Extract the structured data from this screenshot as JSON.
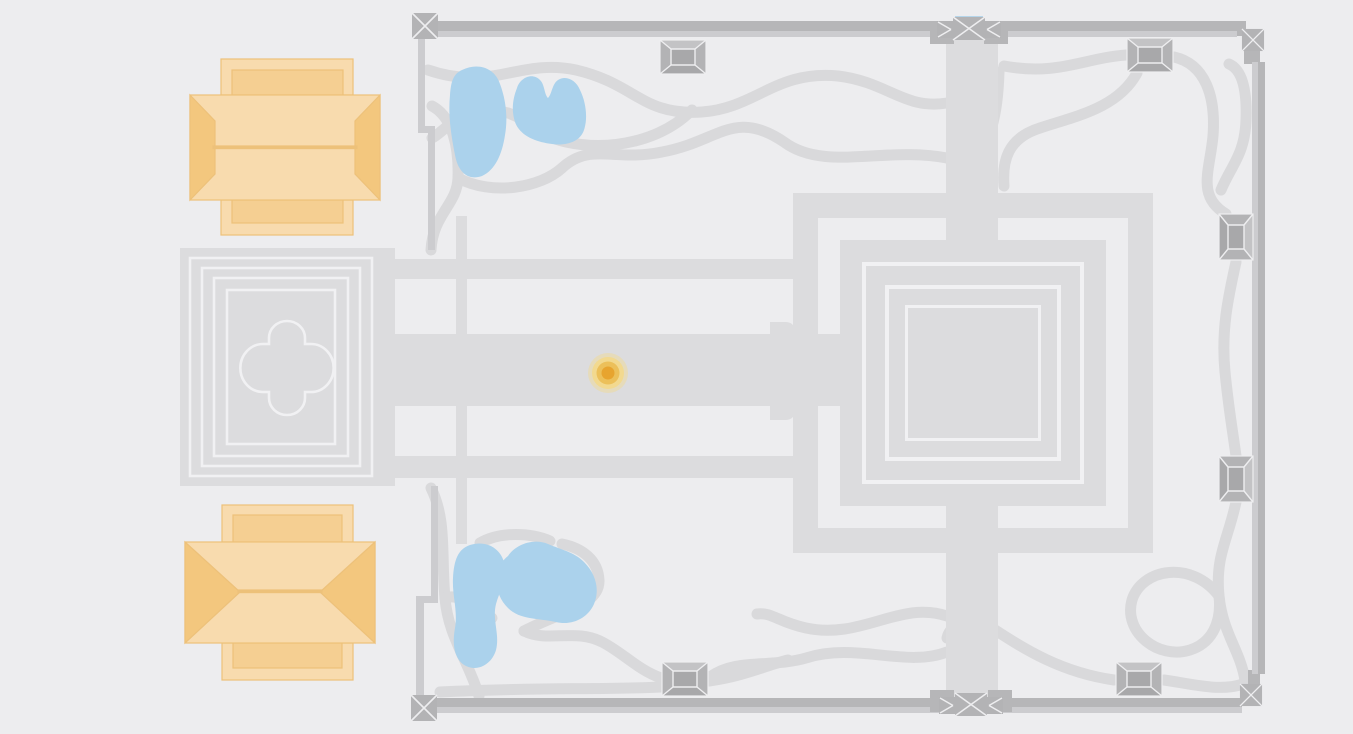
{
  "meta": {
    "title": "Temple complex map",
    "description": "Schematic plan map of a walled temple complex with central sanctuary, western gopura, libraries, ponds and paths. No visible text labels.",
    "visible_text": ""
  },
  "colors": {
    "background": "#ededef",
    "structure": "#dcdcde",
    "path": "#d9d9db",
    "outline": "#f1f1f3",
    "wall_dark": "#b6b6b8",
    "wall_light": "#cccccf",
    "gate_fill": "#b3b3b5",
    "gate_inner": "#a8a8aa",
    "gate_top": "#c3c3c5",
    "seam": "#eeeef0",
    "accent_blue": "#b5d5ea",
    "pond": "#abd2ec",
    "library_light": "#f8dbae",
    "library_mid": "#f5cf92",
    "library_dark": "#f3c77e",
    "library_line": "#edc17a",
    "marker_outer": "#f2d98f",
    "marker_mid": "#ecc05a",
    "marker_core": "#e7a42f"
  },
  "marker": {
    "name": "location-marker",
    "x": 608,
    "y": 373
  },
  "features": {
    "corner_towers": 4,
    "wall_gatehouses": 6,
    "main_gates": 2,
    "libraries": 2,
    "ponds": 4,
    "central_temple": 1,
    "west_gopura": 1
  }
}
